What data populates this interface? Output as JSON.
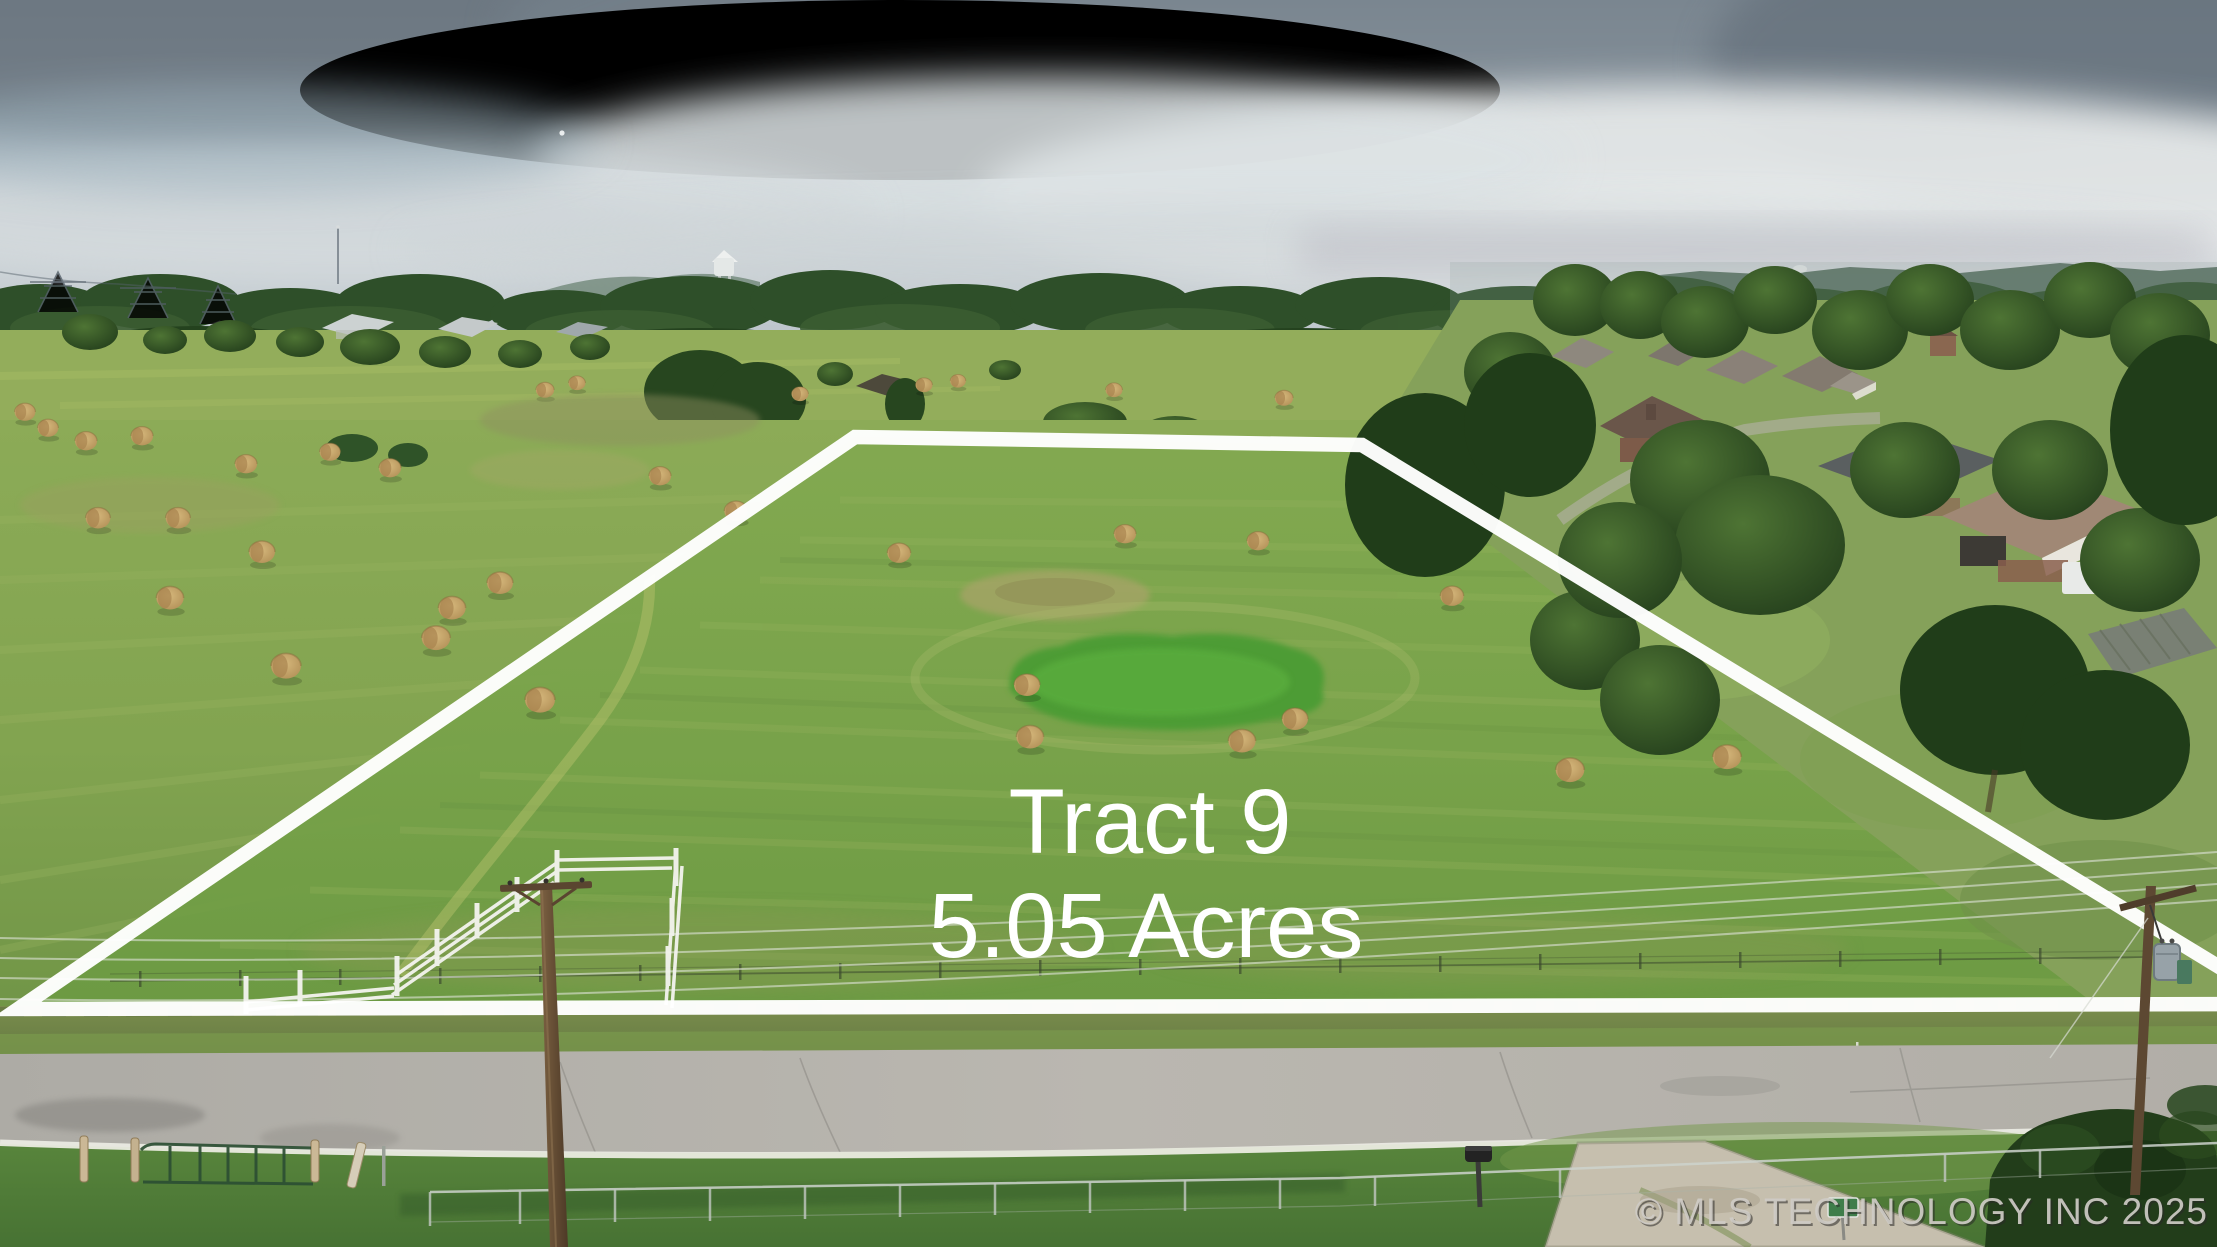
{
  "title": "Aerial land listing photo",
  "overlay": {
    "tract_label": "Tract 9",
    "acreage_label": "5.05 Acres",
    "boundary_color": "#ffffff",
    "label_color": "#ffffff"
  },
  "watermark": {
    "text": "© MLS TECHNOLOGY INC 2025",
    "color": "#cfccc6"
  },
  "scene": {
    "setting": "overcast aerial drone view of an outlined hay pasture tract, rural road in the foreground, residential subdivision and tree rows to the right",
    "palette": {
      "sky_dark_cloud": "#6d7882",
      "sky_light": "#dfe3e5",
      "distant_trees": "#33502c",
      "pasture": "#85a452",
      "tract_field": "#7aa24b",
      "vivid_grass_patch": "#4f9d35",
      "hay_bale": "#c9a96b",
      "road": "#b2b0aa",
      "foreground_lawn": "#4f7c36",
      "boundary": "#ffffff"
    },
    "elements": [
      "water-tower",
      "radio-mast",
      "transmission-towers",
      "farmhouses",
      "barn",
      "hay-bales",
      "subdivision-houses",
      "enclosed-trailer",
      "utility-poles",
      "power-lines",
      "transformer",
      "corral-fence",
      "field-gate",
      "barbed-wire-fence",
      "chain-link-fence",
      "mailbox",
      "yard-sign",
      "gravel-driveway",
      "road-fog-line",
      "roadside-trees"
    ],
    "hay_bale_count": 37
  }
}
